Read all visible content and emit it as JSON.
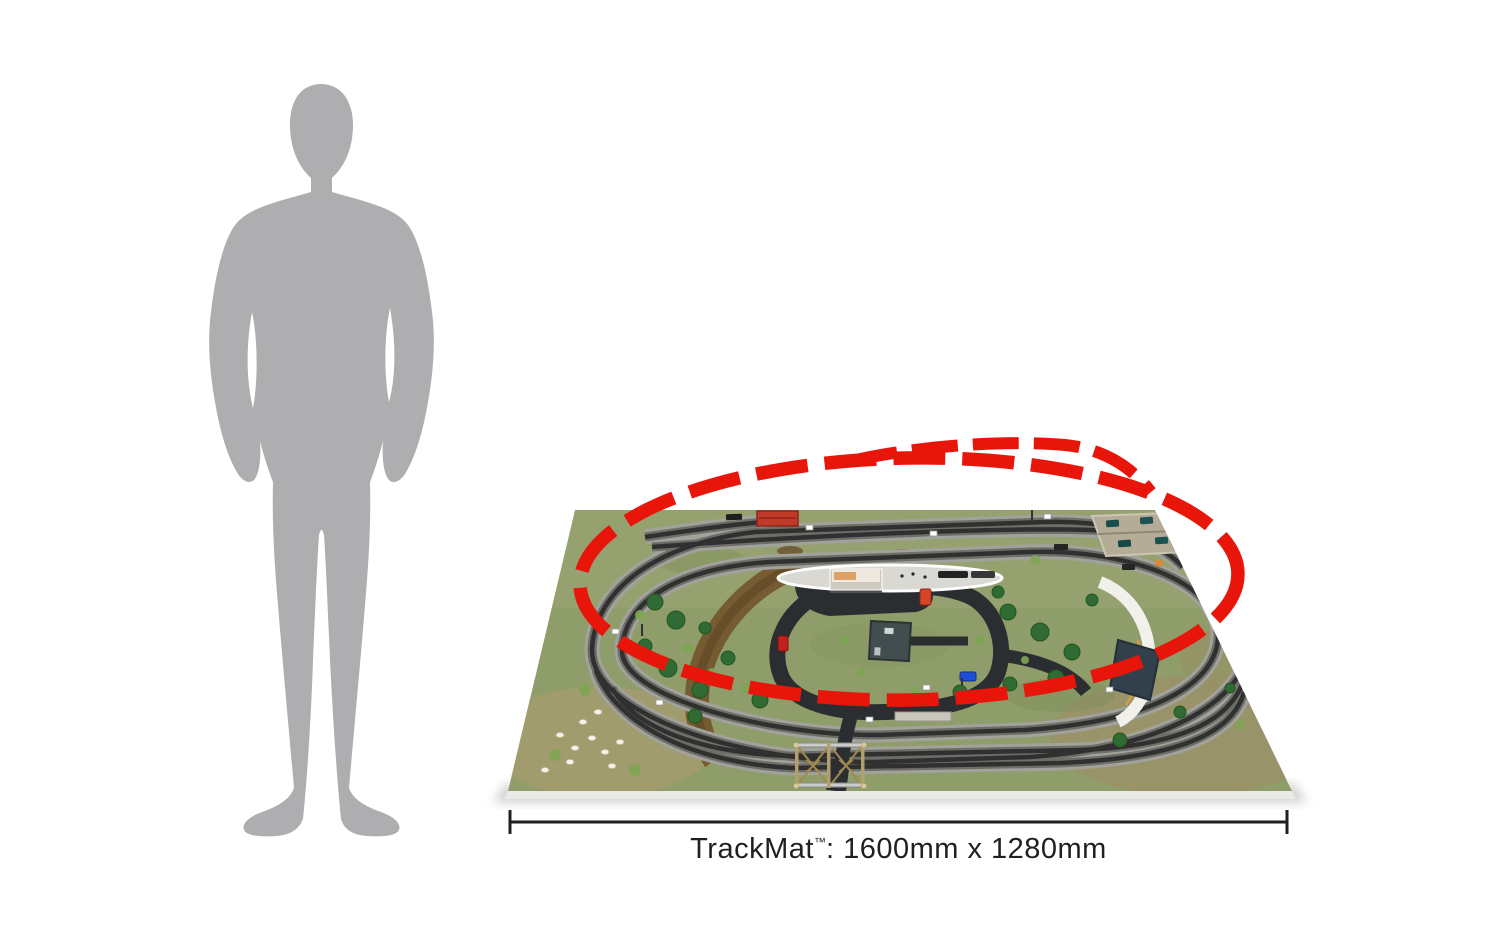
{
  "page": {
    "background": "#ffffff"
  },
  "scale_figure": {
    "type": "human-silhouette",
    "color": "#aeaeb0"
  },
  "trackmat": {
    "caption": {
      "product": "TrackMat",
      "trademark_symbol": "™",
      "separator": ": ",
      "dimensions": "1600mm x 1280mm",
      "full_text": "TrackMat™: 1600mm x 1280mm"
    },
    "highlight": {
      "shape": "dashed-oval-with-siding-branch",
      "color": "#e8150b"
    },
    "colors": {
      "grass": "#8f9d6a",
      "track_ballast": "#a2a29c",
      "road": "#2b2e30",
      "platform": "#d9d8d3",
      "dirt_path": "#74572f",
      "dimension_line": "#231f20"
    }
  }
}
